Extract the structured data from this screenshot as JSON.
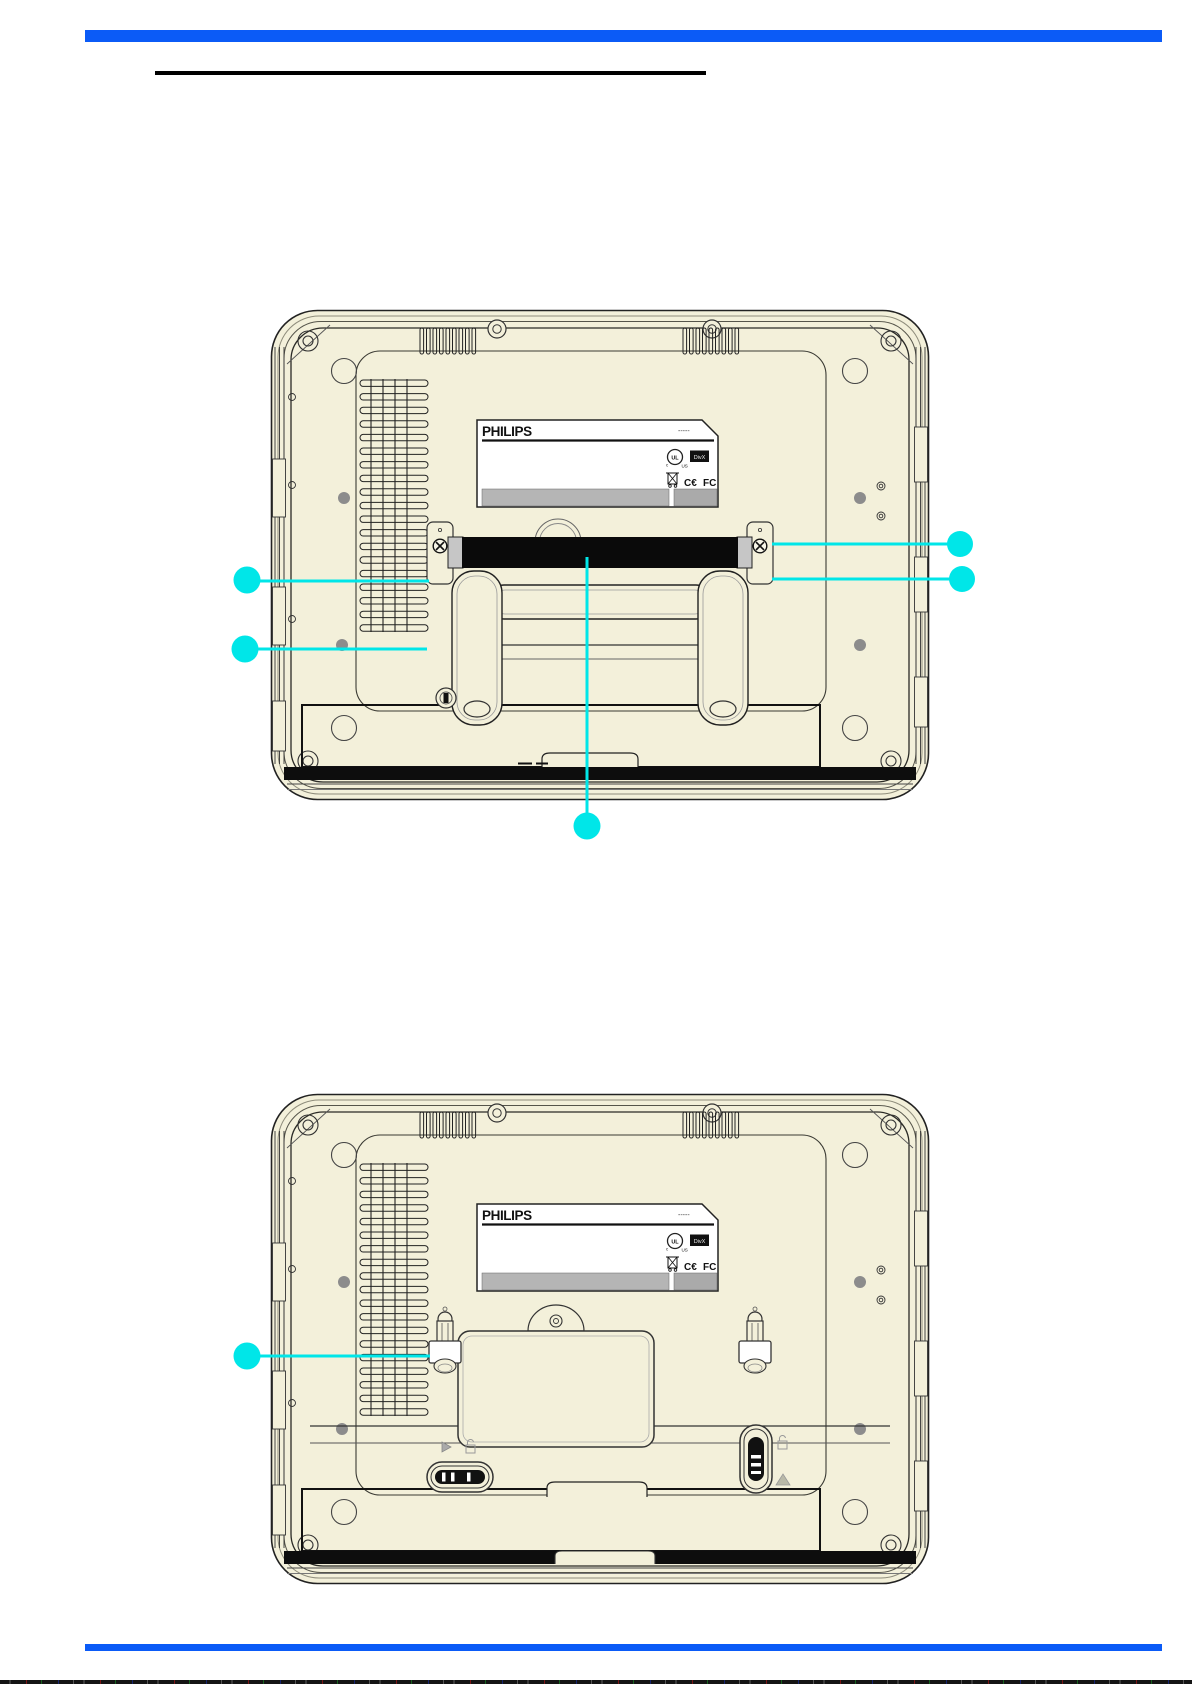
{
  "page": {
    "title_text": "",
    "header_bar_color": "#0b5bf7",
    "footer_bar_color": "#0b5bf7"
  },
  "colors": {
    "body_fill": "#f3f0da",
    "outline": "#1f1f1f",
    "callout": "#00e6e8",
    "strap_black": "#0a0a0a",
    "label_gray_bar": "#b5b5b5",
    "label_gray_box": "#aaaaaa",
    "screw_dot_gray": "#8c8c8c"
  },
  "device_label": {
    "brand": "PHILIPS",
    "serial_dashes": "-----",
    "ul_text": "UL",
    "ul_c": "c",
    "ul_us": "US",
    "divx_text": "DivX",
    "ce_text": "C€",
    "fcc_text": "FC"
  },
  "diagrams": [
    {
      "name": "rear-view-with-strap-and-stand",
      "callouts": [
        {
          "id": "left-upper",
          "x1": 429,
          "y1": 581,
          "x2": 249,
          "y2": 581,
          "cx": 247,
          "cy": 580,
          "r": 13.5
        },
        {
          "id": "left-lower",
          "x1": 427,
          "y1": 649,
          "x2": 247,
          "y2": 649,
          "cx": 245,
          "cy": 649,
          "r": 13.5
        },
        {
          "id": "right-upper",
          "x1": 772,
          "y1": 544,
          "x2": 948,
          "y2": 544,
          "cx": 960,
          "cy": 544,
          "r": 13
        },
        {
          "id": "right-lower",
          "x1": 772,
          "y1": 579,
          "x2": 950,
          "y2": 579,
          "cx": 962,
          "cy": 579,
          "r": 13
        },
        {
          "id": "bottom-center",
          "x1": 587,
          "y1": 557,
          "x2": 587,
          "y2": 814,
          "cx": 587,
          "cy": 826,
          "r": 13.5
        }
      ]
    },
    {
      "name": "rear-view-with-mounting-hooks",
      "callouts": [
        {
          "id": "left-hook",
          "x1": 430,
          "y1": 1356,
          "x2": 249,
          "y2": 1356,
          "cx": 247,
          "cy": 1356,
          "r": 13.5
        }
      ]
    }
  ]
}
